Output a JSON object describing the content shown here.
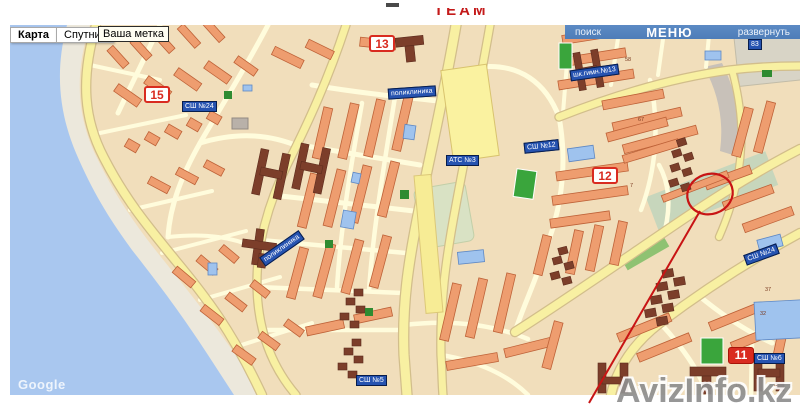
{
  "header": {
    "logo_fragment": "ТЕАМ"
  },
  "map_controls": {
    "map_button": "Карта",
    "satellite_button": "Спутник",
    "your_mark": "Ваша метка"
  },
  "menu_bar": {
    "search": "поиск",
    "menu": "МЕНЮ",
    "expand": "развернуть"
  },
  "markers": {
    "m15": "15",
    "m13": "13",
    "m12": "12",
    "m11": "11"
  },
  "place_labels": {
    "school24": "СШ №24",
    "polyclinic1": "поликлиника",
    "gymnasium13": "шк.гимн.№13",
    "school12": "СШ №12",
    "ats3": "АТС №3",
    "label83": "83",
    "polyclinic2": "поликлиника",
    "school24b": "СШ №24",
    "school6": "СШ №6",
    "school5": "СШ №5"
  },
  "house_numbers": {
    "n1": "58",
    "n2": "67",
    "n3": "7",
    "n4": "37",
    "n5": "32",
    "n6": "14",
    "n7": "13"
  },
  "watermarks": {
    "map_provider": "Google",
    "site": "AvizInfo.kz"
  },
  "colors": {
    "land": "#F1DEBB",
    "water": "#A9C7EF",
    "beach": "#ECE8DC",
    "road_major": "#F8F0A2",
    "road_minor": "#FFFCDC",
    "building": "#EE9D6F",
    "building_dark": "#7C3E2A",
    "field_green": "#3AA53C",
    "marker_red": "#D92B20",
    "label_blue": "#2653B0",
    "menu_blue": "#4E7DB8",
    "annotation_red": "#C81414"
  }
}
